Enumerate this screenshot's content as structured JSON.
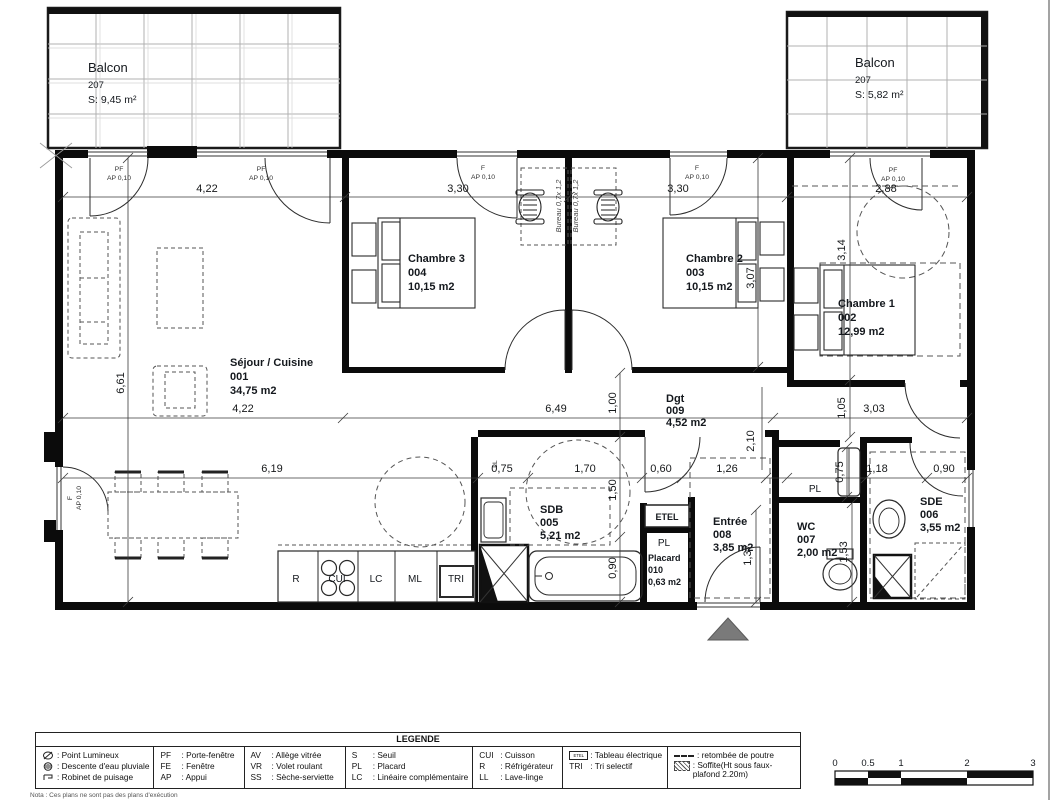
{
  "balconies": {
    "left": {
      "title": "Balcon",
      "number": "207",
      "area": "S: 9,45 m²"
    },
    "right": {
      "title": "Balcon",
      "number": "207",
      "area": "S: 5,82 m²"
    }
  },
  "rooms": {
    "sejour": {
      "name": "Séjour / Cuisine",
      "number": "001",
      "area": "34,75 m2"
    },
    "chambre1": {
      "name": "Chambre 1",
      "number": "002",
      "area": "12,99 m2"
    },
    "chambre2": {
      "name": "Chambre 2",
      "number": "003",
      "area": "10,15 m2"
    },
    "chambre3": {
      "name": "Chambre 3",
      "number": "004",
      "area": "10,15 m2"
    },
    "sdb": {
      "name": "SDB",
      "number": "005",
      "area": "5,21 m2"
    },
    "sde": {
      "name": "SDE",
      "number": "006",
      "area": "3,55 m2"
    },
    "wc": {
      "name": "WC",
      "number": "007",
      "area": "2,00 m2"
    },
    "entree": {
      "name": "Entrée",
      "number": "008",
      "area": "3,85 m2"
    },
    "dgt": {
      "name": "Dgt",
      "number": "009",
      "area": "4,52 m2"
    },
    "placard": {
      "name": "Placard",
      "number": "010",
      "area": "0,63 m2"
    }
  },
  "labels": {
    "pf": "PF",
    "f": "F",
    "ap": "AP 0,10",
    "pl": "PL",
    "etel": "ETEL",
    "ll": "LL",
    "bureau": "Bureau 0,7x 1,2",
    "kitchen": {
      "r": "R",
      "cui": "CUI",
      "lc": "LC",
      "ml": "ML",
      "tri": "TRI"
    }
  },
  "dims": {
    "top": [
      "4,22",
      "3,30",
      "3,30",
      "2,88"
    ],
    "mid": [
      "4,22",
      "6,49",
      "3,03"
    ],
    "low": [
      "6,19",
      "0,75",
      "1,70",
      "0,60",
      "1,26",
      "1,18",
      "0,90"
    ],
    "v_sejour": "6,61",
    "v_ch2": "3,07",
    "v_ch1": "3,14",
    "v_105": "1,05",
    "v_100": "1,00",
    "v_210": "2,10",
    "v_150": "1,50",
    "v_090": "0,90",
    "v_075": "0,75",
    "v_153": "1,53",
    "v_137": "1,37"
  },
  "legend": {
    "title": "LEGENDE",
    "col1": [
      {
        "label": ": Point Lumineux"
      },
      {
        "label": ": Descente d'eau pluviale"
      },
      {
        "label": ": Robinet de puisage"
      }
    ],
    "col2": [
      {
        "abbr": "PF",
        "label": ": Porte-fenêtre"
      },
      {
        "abbr": "FE",
        "label": ": Fenêtre"
      },
      {
        "abbr": "AP",
        "label": ": Appui"
      }
    ],
    "col3": [
      {
        "abbr": "AV",
        "label": ": Allège vitrée"
      },
      {
        "abbr": "VR",
        "label": ": Volet roulant"
      },
      {
        "abbr": "SS",
        "label": ": Sèche-serviette"
      }
    ],
    "col4": [
      {
        "abbr": "S",
        "label": ": Seuil"
      },
      {
        "abbr": "PL",
        "label": ": Placard"
      },
      {
        "abbr": "LC",
        "label": ": Linéaire complémentaire"
      }
    ],
    "col5": [
      {
        "abbr": "CUI",
        "label": ": Cuisson"
      },
      {
        "abbr": "R",
        "label": ": Réfrigérateur"
      },
      {
        "abbr": "LL",
        "label": ": Lave-linge"
      }
    ],
    "col6": [
      {
        "abbr": "ETEL",
        "label": ": Tableau électrique"
      },
      {
        "abbr": "TRI",
        "label": ": Tri selectif"
      }
    ],
    "col7": [
      {
        "label": ": retombée de poutre"
      },
      {
        "label": ": Soffite(Ht sous faux-plafond 2.20m)"
      }
    ]
  },
  "scalebar": [
    "0",
    "0.5",
    "1",
    "2",
    "3"
  ],
  "note": "Nota : Ces plans ne sont pas des plans d'exécution"
}
